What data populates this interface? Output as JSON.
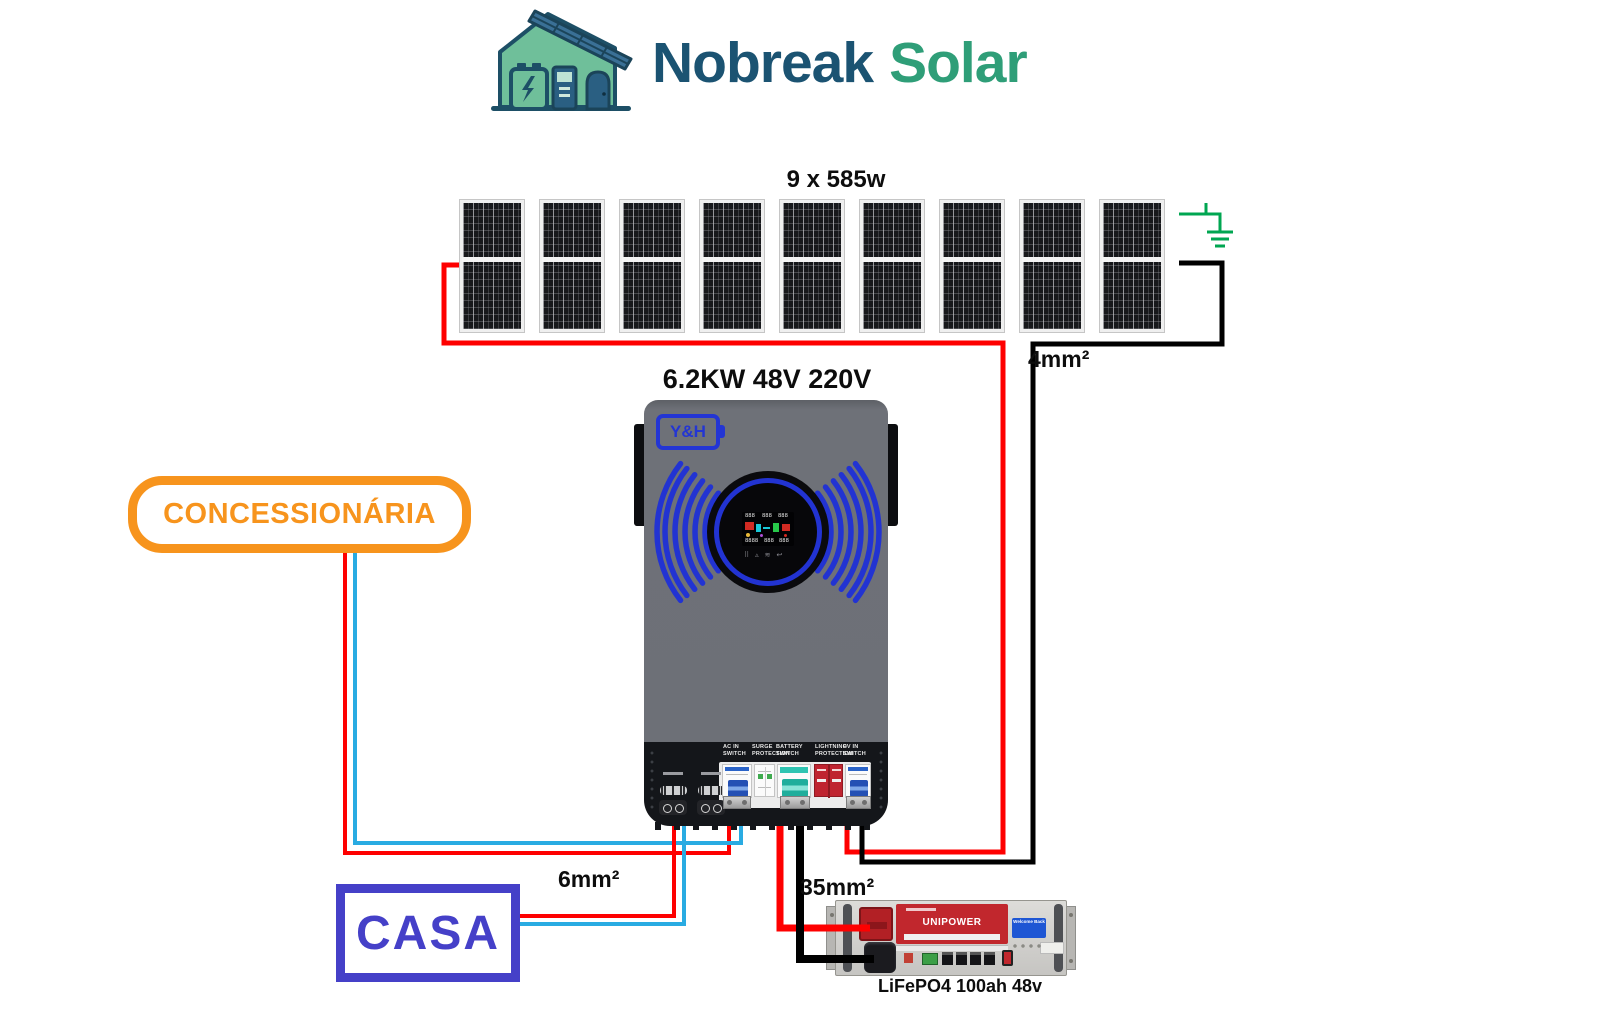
{
  "header": {
    "brand_primary": "Nobreak",
    "brand_secondary": "Solar",
    "brand_primary_color": "#1b5372",
    "brand_secondary_color": "#2f9e78"
  },
  "pv_array": {
    "label": "9 x 585w",
    "panel_count": 9,
    "gauge_label": "4mm²"
  },
  "inverter": {
    "title": "6.2KW 48V 220V",
    "brand": "Y&H",
    "switch_labels": [
      {
        "text": "AC IN\nSWITCH",
        "x": 723
      },
      {
        "text": "SURGE\nPROTECTION",
        "x": 752
      },
      {
        "text": "BATTERY\nSWITCH",
        "x": 776
      },
      {
        "text": "LIGHTNING\nPROTECTION",
        "x": 815
      },
      {
        "text": "PV IN\nSWITCH",
        "x": 843
      }
    ],
    "display_buttons": [
      "⠿",
      "▵",
      "≋",
      "↩"
    ],
    "accent_blue": "#2233d2"
  },
  "grid_box": {
    "label": "CONCESSIONÁRIA",
    "color": "#f7941d"
  },
  "house_box": {
    "label": "CASA",
    "color": "#4540c8",
    "gauge_label": "6mm²"
  },
  "battery": {
    "brand": "UNIPOWER",
    "tag": "Welcome Back",
    "caption": "LiFePO4 100ah 48v",
    "gauge_label": "35mm²"
  },
  "colors": {
    "wire_red": "#fe0000",
    "wire_black": "#000000",
    "wire_cyan": "#29abe2",
    "ground_green": "#00a651"
  },
  "wires": [
    {
      "name": "pv-positive",
      "layer": "back",
      "color": "#fe0000",
      "width": 5,
      "points": [
        [
          459,
          265
        ],
        [
          444,
          265
        ],
        [
          444,
          343
        ],
        [
          1003,
          343
        ],
        [
          1003,
          852
        ],
        [
          847,
          852
        ],
        [
          847,
          816
        ]
      ]
    },
    {
      "name": "pv-negative",
      "layer": "back",
      "color": "#000000",
      "width": 5,
      "points": [
        [
          1179,
          263
        ],
        [
          1222,
          263
        ],
        [
          1222,
          344
        ],
        [
          1033,
          344
        ],
        [
          1033,
          862
        ],
        [
          862,
          862
        ],
        [
          862,
          816
        ]
      ]
    },
    {
      "name": "grid-live",
      "layer": "back",
      "color": "#fe0000",
      "width": 4,
      "points": [
        [
          345,
          545
        ],
        [
          345,
          853
        ],
        [
          729,
          853
        ],
        [
          729,
          816
        ]
      ]
    },
    {
      "name": "grid-neutral",
      "layer": "back",
      "color": "#29abe2",
      "width": 4,
      "points": [
        [
          355,
          545
        ],
        [
          355,
          843
        ],
        [
          741,
          843
        ],
        [
          741,
          816
        ]
      ]
    },
    {
      "name": "house-live",
      "layer": "back",
      "color": "#fe0000",
      "width": 4,
      "points": [
        [
          510,
          916
        ],
        [
          674,
          916
        ],
        [
          674,
          816
        ]
      ]
    },
    {
      "name": "house-neutral",
      "layer": "back",
      "color": "#29abe2",
      "width": 4,
      "points": [
        [
          510,
          924
        ],
        [
          684,
          924
        ],
        [
          684,
          816
        ]
      ]
    },
    {
      "name": "battery-positive",
      "layer": "front",
      "color": "#fe0000",
      "width": 7,
      "points": [
        [
          780,
          816
        ],
        [
          780,
          928
        ],
        [
          870,
          928
        ]
      ]
    },
    {
      "name": "battery-negative",
      "layer": "front",
      "color": "#000000",
      "width": 8,
      "points": [
        [
          800,
          816
        ],
        [
          800,
          959
        ],
        [
          874,
          959
        ]
      ]
    },
    {
      "name": "ground-lead",
      "layer": "ground",
      "color": "#00a651",
      "width": 3,
      "points": [
        [
          1179,
          214
        ],
        [
          1220,
          214
        ],
        [
          1220,
          232
        ]
      ]
    },
    {
      "name": "ground-tick",
      "layer": "ground",
      "color": "#00a651",
      "width": 3,
      "points": [
        [
          1206,
          214
        ],
        [
          1206,
          203
        ]
      ]
    },
    {
      "name": "ground-bar1",
      "layer": "ground",
      "color": "#00a651",
      "width": 3,
      "points": [
        [
          1207,
          232
        ],
        [
          1233,
          232
        ]
      ]
    },
    {
      "name": "ground-bar2",
      "layer": "ground",
      "color": "#00a651",
      "width": 3,
      "points": [
        [
          1211,
          239
        ],
        [
          1229,
          239
        ]
      ]
    },
    {
      "name": "ground-bar3",
      "layer": "ground",
      "color": "#00a651",
      "width": 3,
      "points": [
        [
          1215,
          246
        ],
        [
          1225,
          246
        ]
      ]
    }
  ]
}
